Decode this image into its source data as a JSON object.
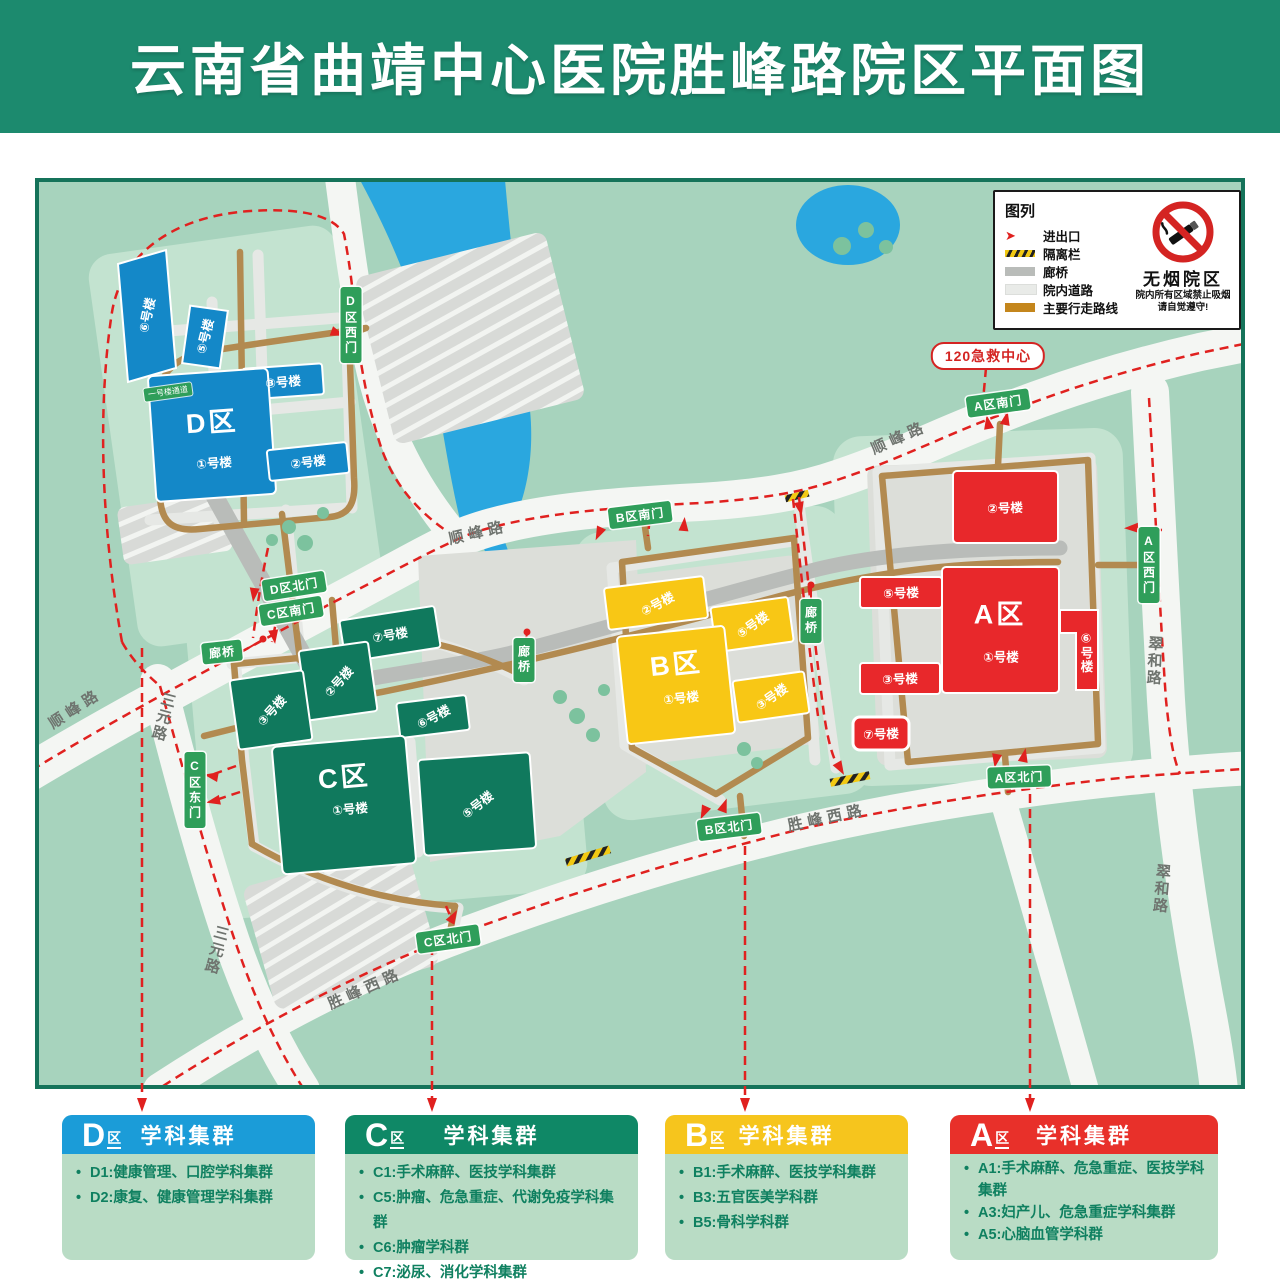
{
  "header": {
    "title": "云南省曲靖中心医院胜峰路院区平面图",
    "bg_color": "#1c8a6e"
  },
  "legend": {
    "title": "图列",
    "items": [
      {
        "icon": "entrance-arrow",
        "label": "进出口",
        "color": "#e0211f"
      },
      {
        "icon": "barrier-stripe",
        "label": "隔离栏",
        "color": "#f2c912"
      },
      {
        "icon": "corridor-bar",
        "label": "廊桥",
        "color": "#b9bcb9"
      },
      {
        "icon": "internal-road-bar",
        "label": "院内道路",
        "color": "#e9ebe8"
      },
      {
        "icon": "main-route-bar",
        "label": "主要行走路线",
        "color": "#c4861c"
      }
    ]
  },
  "nosmoking": {
    "title": "无烟院区",
    "line1": "院内所有区域禁止吸烟",
    "line2": "请自觉遵守!"
  },
  "emergency": {
    "label": "120急救中心"
  },
  "roads": {
    "shunfeng": "顺峰路",
    "sanyuan": "三元路",
    "shengfeng_west": "胜峰西路",
    "cuihe": "翠和路"
  },
  "gates": {
    "d_west": "D区西门",
    "d_north": "D区北门",
    "c_south": "C区南门",
    "c_east": "C区东门",
    "c_north": "C区北门",
    "b_south": "B区南门",
    "b_north": "B区北门",
    "a_south": "A区南门",
    "a_west": "A区西门",
    "a_north": "A区北门"
  },
  "bridges": {
    "label": "廊桥"
  },
  "minisign": {
    "label": "一号楼通道"
  },
  "zones": {
    "D": {
      "label": "D区",
      "color": "#1488c8"
    },
    "C": {
      "label": "C区",
      "color": "#10795d"
    },
    "B": {
      "label": "B区",
      "color": "#f8c715"
    },
    "A": {
      "label": "A区",
      "color": "#e8282b"
    }
  },
  "bnames": {
    "1": "①号楼",
    "2": "②号楼",
    "3": "③号楼",
    "5": "⑤号楼",
    "6": "⑥号楼",
    "7": "⑦号楼"
  },
  "cards": [
    {
      "letter": "D",
      "suffix": "区",
      "cluster": "学科集群",
      "color": "#1b9cd8",
      "items": [
        "D1:健康管理、口腔学科集群",
        "D2:康复、健康管理学科集群"
      ]
    },
    {
      "letter": "C",
      "suffix": "区",
      "cluster": "学科集群",
      "color": "#0f8866",
      "items": [
        "C1:手术麻醉、医技学科集群",
        "C5:肿瘤、危急重症、代谢免疫学科集群",
        "C6:肿瘤学科群",
        "C7:泌尿、消化学科集群"
      ]
    },
    {
      "letter": "B",
      "suffix": "区",
      "cluster": "学科集群",
      "color": "#f6c51d",
      "items": [
        "B1:手术麻醉、医技学科集群",
        "B3:五官医美学科群",
        "B5:骨科学科群"
      ]
    },
    {
      "letter": "A",
      "suffix": "区",
      "cluster": "学科集群",
      "color": "#e8302a",
      "items": [
        "A1:手术麻醉、危急重症、医技学科集群",
        "A3:妇产儿、危急重症学科集群",
        "A5:心脑血管学科群"
      ]
    }
  ]
}
